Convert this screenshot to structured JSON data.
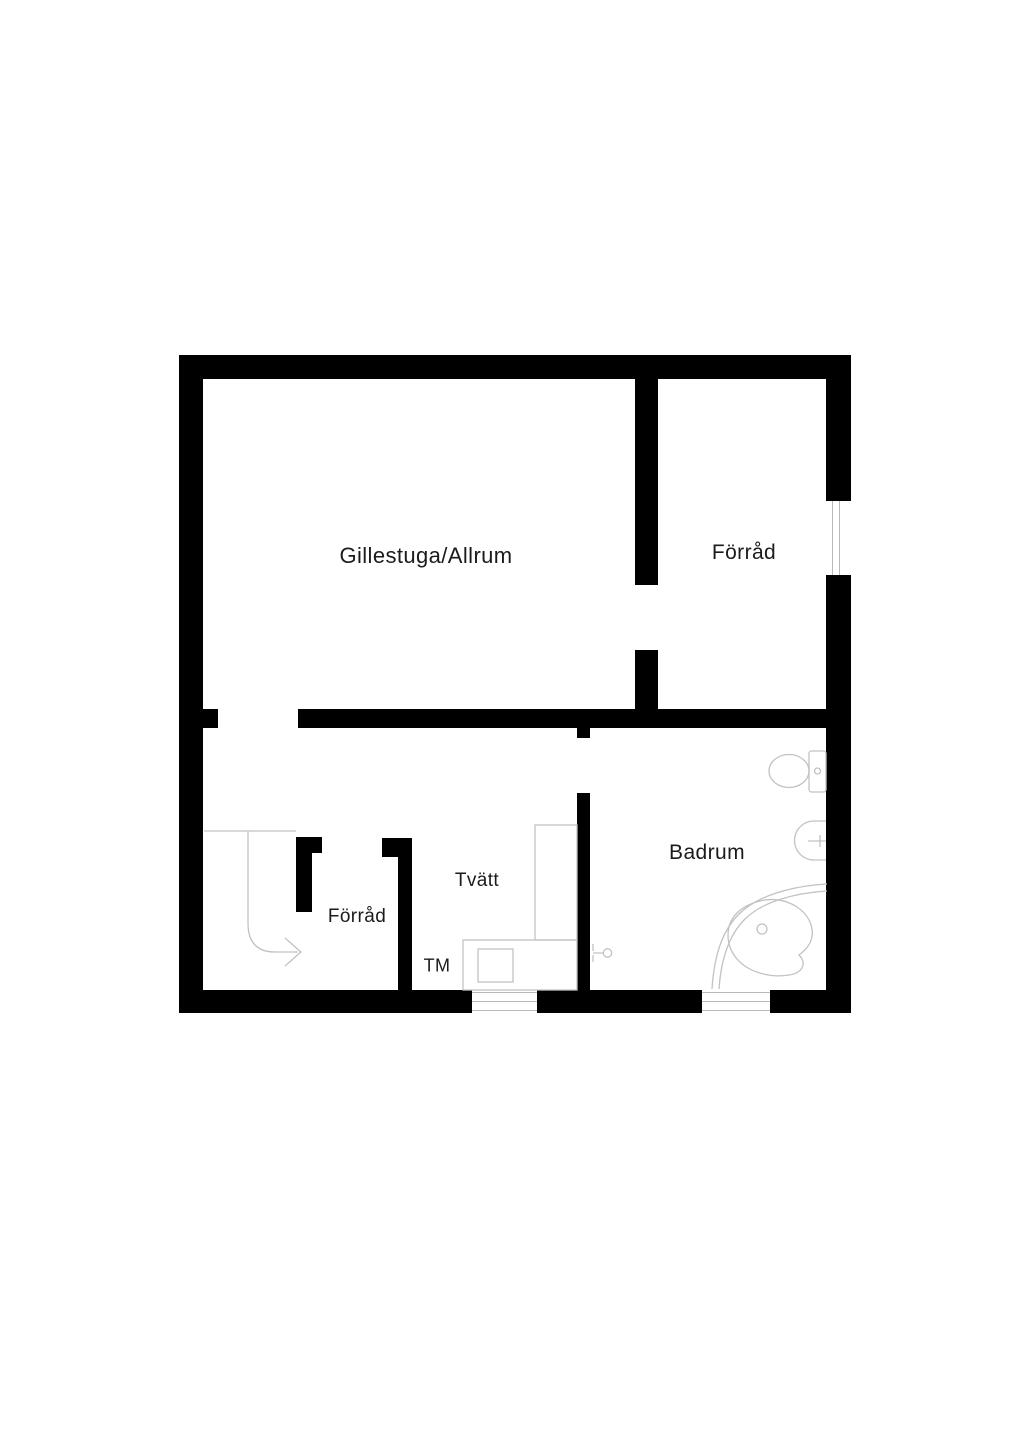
{
  "floorplan": {
    "type": "basement-floor-plan",
    "wall_color": "#000000",
    "fixture_line_color": "#c2c2c2",
    "label_color": "#1b1b1b",
    "background_color": "#ffffff",
    "rooms": [
      {
        "id": "gillestuga",
        "label": "Gillestuga/Allrum"
      },
      {
        "id": "forrad-top",
        "label": "Förråd"
      },
      {
        "id": "forrad-small",
        "label": "Förråd"
      },
      {
        "id": "tvatt",
        "label": "Tvätt"
      },
      {
        "id": "badrum",
        "label": "Badrum"
      }
    ],
    "appliance_labels": {
      "tm": "TM"
    },
    "fixtures": [
      "stairs-with-direction-arrow",
      "toilet",
      "wall-sink",
      "corner-bathtub",
      "washing-machine",
      "laundry-counter",
      "door-handle-symbol",
      "window-right-wall",
      "window-bottom-tvatt",
      "window-bottom-badrum"
    ]
  }
}
